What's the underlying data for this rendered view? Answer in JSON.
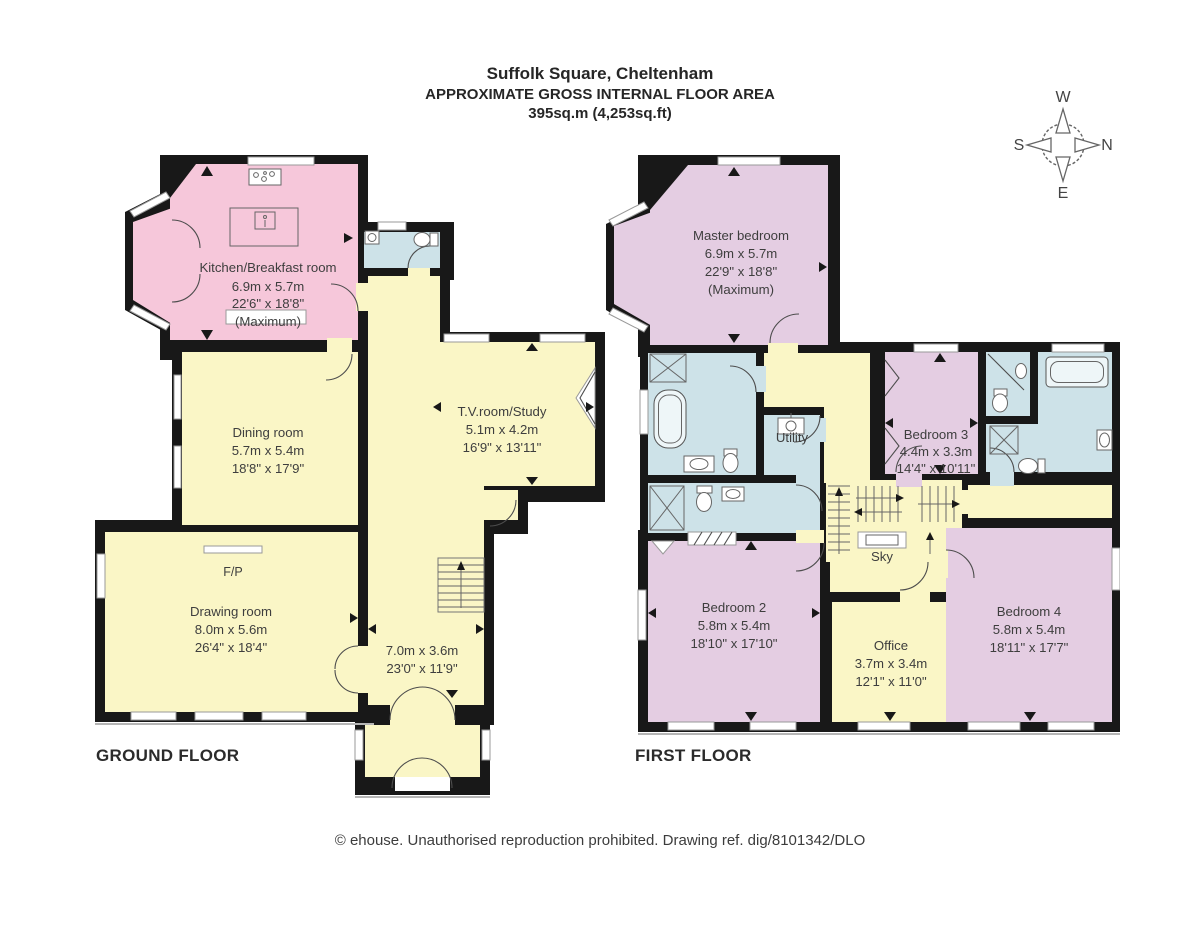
{
  "title": {
    "line1": "Suffolk Square, Cheltenham",
    "line2": "APPROXIMATE GROSS INTERNAL FLOOR AREA",
    "line3": "395sq.m (4,253sq.ft)"
  },
  "compass": {
    "top": "W",
    "left": "S",
    "right": "N",
    "bottom": "E"
  },
  "ground_floor": {
    "label": "GROUND FLOOR",
    "rooms": {
      "kitchen": {
        "name": "Kitchen/Breakfast room",
        "metric": "6.9m x 5.7m",
        "imperial": "22'6\" x 18'8\"",
        "note": "(Maximum)"
      },
      "dining": {
        "name": "Dining room",
        "metric": "5.7m x 5.4m",
        "imperial": "18'8\" x 17'9\""
      },
      "tv": {
        "name": "T.V.room/Study",
        "metric": "5.1m x 4.2m",
        "imperial": "16'9\" x 13'11\""
      },
      "drawing": {
        "name": "Drawing room",
        "metric": "8.0m x 5.6m",
        "imperial": "26'4\" x 18'4\""
      },
      "hall": {
        "metric": "7.0m x 3.6m",
        "imperial": "23'0\" x 11'9\""
      },
      "fireplace": "F/P"
    }
  },
  "first_floor": {
    "label": "FIRST FLOOR",
    "rooms": {
      "master": {
        "name": "Master bedroom",
        "metric": "6.9m x 5.7m",
        "imperial": "22'9\" x 18'8\"",
        "note": "(Maximum)"
      },
      "utility": {
        "name": "Utility"
      },
      "bedroom3": {
        "name": "Bedroom 3",
        "metric": "4.4m x 3.3m",
        "imperial": "14'4\" x 10'11\""
      },
      "bedroom2": {
        "name": "Bedroom 2",
        "metric": "5.8m x 5.4m",
        "imperial": "18'10\" x 17'10\""
      },
      "office": {
        "name": "Office",
        "metric": "3.7m x 3.4m",
        "imperial": "12'1\" x 11'0\""
      },
      "bedroom4": {
        "name": "Bedroom 4",
        "metric": "5.8m x 5.4m",
        "imperial": "18'11\" x 17'7\""
      },
      "skylight": "Sky"
    }
  },
  "footer": "© ehouse. Unauthorised reproduction prohibited. Drawing ref. dig/8101342/DLO",
  "colors": {
    "kitchen_pink": "#f6c7da",
    "bedroom_lilac": "#e4cde2",
    "living_yellow": "#faf6c6",
    "bath_blue": "#cde2e8",
    "wall": "#181818"
  }
}
